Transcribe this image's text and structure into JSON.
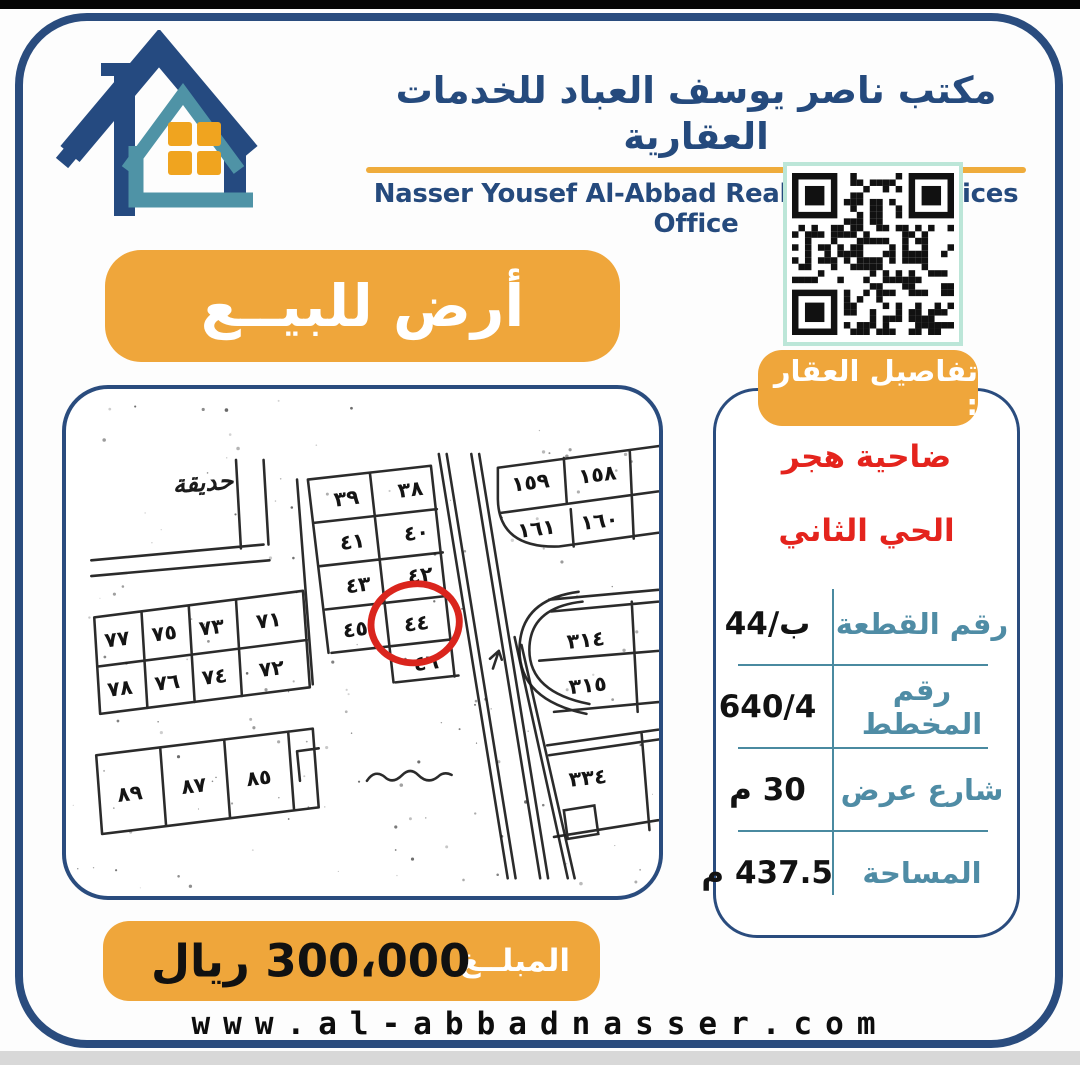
{
  "header": {
    "title_ar": "مكتب ناصر يوسف العباد للخدمات العقارية",
    "title_en": "Nasser Yousef Al-Abbad Real Estate Services Office"
  },
  "sale_banner": {
    "label": "أرض للبيــع"
  },
  "details": {
    "tag": "تفاصيل العقار :",
    "location_line1": "ضاحية هجر",
    "location_line2": "الحي الثاني",
    "rows": [
      {
        "label": "رقم القطعة",
        "value": "ب/44"
      },
      {
        "label": "رقم المخطط",
        "value": "640/4"
      },
      {
        "label": "شارع عرض",
        "value": "30 م"
      },
      {
        "label": "المساحة",
        "value": "437.5 م"
      }
    ]
  },
  "map": {
    "area_label": "حديقة",
    "circled_plot": "٤٤",
    "plots": [
      "٣٩",
      "٣٨",
      "٤١",
      "٤٠",
      "٤٣",
      "٤٢",
      "٤٥",
      "٤٤",
      "٤٦",
      "٧٧",
      "٧٥",
      "٧٣",
      "٧١",
      "٧٨",
      "٧٦",
      "٧٤",
      "٧٢",
      "٨٩",
      "٨٧",
      "٨٥",
      "١٥٩",
      "١٥٨",
      "١٦١",
      "١٦٠",
      "٣١٤",
      "٣١٥",
      "٣٣٤"
    ]
  },
  "amount": {
    "label": "المبلــغ",
    "value": "300،000 ريال"
  },
  "footer": {
    "website": "www.al-abbadnasser.com"
  },
  "colors": {
    "accent_orange": "#EFA63B",
    "navy": "#2A4C7E",
    "teal_label": "#4F8CA5",
    "red_text": "#E4241D",
    "mint_qr_border": "#BCE6D8",
    "map_circle_red": "#DA251D"
  }
}
